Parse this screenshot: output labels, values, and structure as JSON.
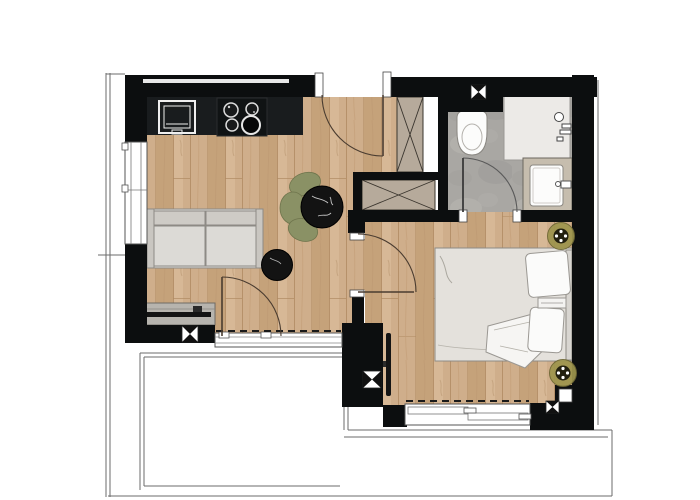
{
  "document": {
    "type": "architectural-floor-plan",
    "description": "Top-down apartment floor plan: open living room with kitchenette, entry hall with wardrobes, bathroom with toilet shower and vanity, bedroom with double bed, terrace outline below",
    "text_labels": []
  },
  "colors": {
    "bg": "#ffffff",
    "wall": "#0c0e0f",
    "wood": "#cfae8b",
    "wood_stripe": "#c5a27a",
    "wood_light": "#d7b896",
    "plank_line": "#b08a62",
    "tile": "#a9a7a3",
    "tile_light": "#b7b5b1",
    "shower": "#eceae7",
    "wardrobe": "#b6aa9b",
    "sofa": "#dcdad6",
    "sofa_back": "#cecbc6",
    "sofa_arm": "#c9c6c1",
    "sideboard": "#b7b4ae",
    "tv_black": "#141414",
    "bed": "#e4e1dc",
    "pillow": "#fbfbfa",
    "vanity": "#c6bdae",
    "fixture_white": "#fcfcfb",
    "plant_green": "#8a9165",
    "accent_olive": "#9e954d",
    "olive_dark": "#23200f",
    "marble_black": "#131313",
    "door_line": "#4a3c30",
    "thin_line": "#6b6b6b",
    "frame_stroke": "#555555"
  },
  "rooms": [
    {
      "id": "living-kitchen",
      "floor": "oak-planks"
    },
    {
      "id": "entry-hall",
      "floor": "oak-planks"
    },
    {
      "id": "bathroom",
      "floor": "stone-tile"
    },
    {
      "id": "bedroom",
      "floor": "oak-planks"
    },
    {
      "id": "terrace",
      "floor": "outline-only"
    }
  ],
  "furniture": {
    "kitchen": {
      "counter": 1,
      "sink": 1,
      "cooktop_burners": 4
    },
    "living": {
      "sofa_seats": 2,
      "coffee_table": 1,
      "dining_table": 1,
      "plant": 1,
      "tv_sideboard": 1
    },
    "hall": {
      "wardrobes": 2
    },
    "bedroom": {
      "double_bed": 1,
      "pillows": 2,
      "wall_tv": 1,
      "round_fixtures": 2
    },
    "bathroom": {
      "toilet": 1,
      "shower": 1,
      "vanity_sink": 1
    }
  },
  "openings": {
    "entry_door": 1,
    "bedroom_door": 1,
    "bathroom_door": 1,
    "terrace_door": 1,
    "windows": 3,
    "section_markers": 4
  }
}
